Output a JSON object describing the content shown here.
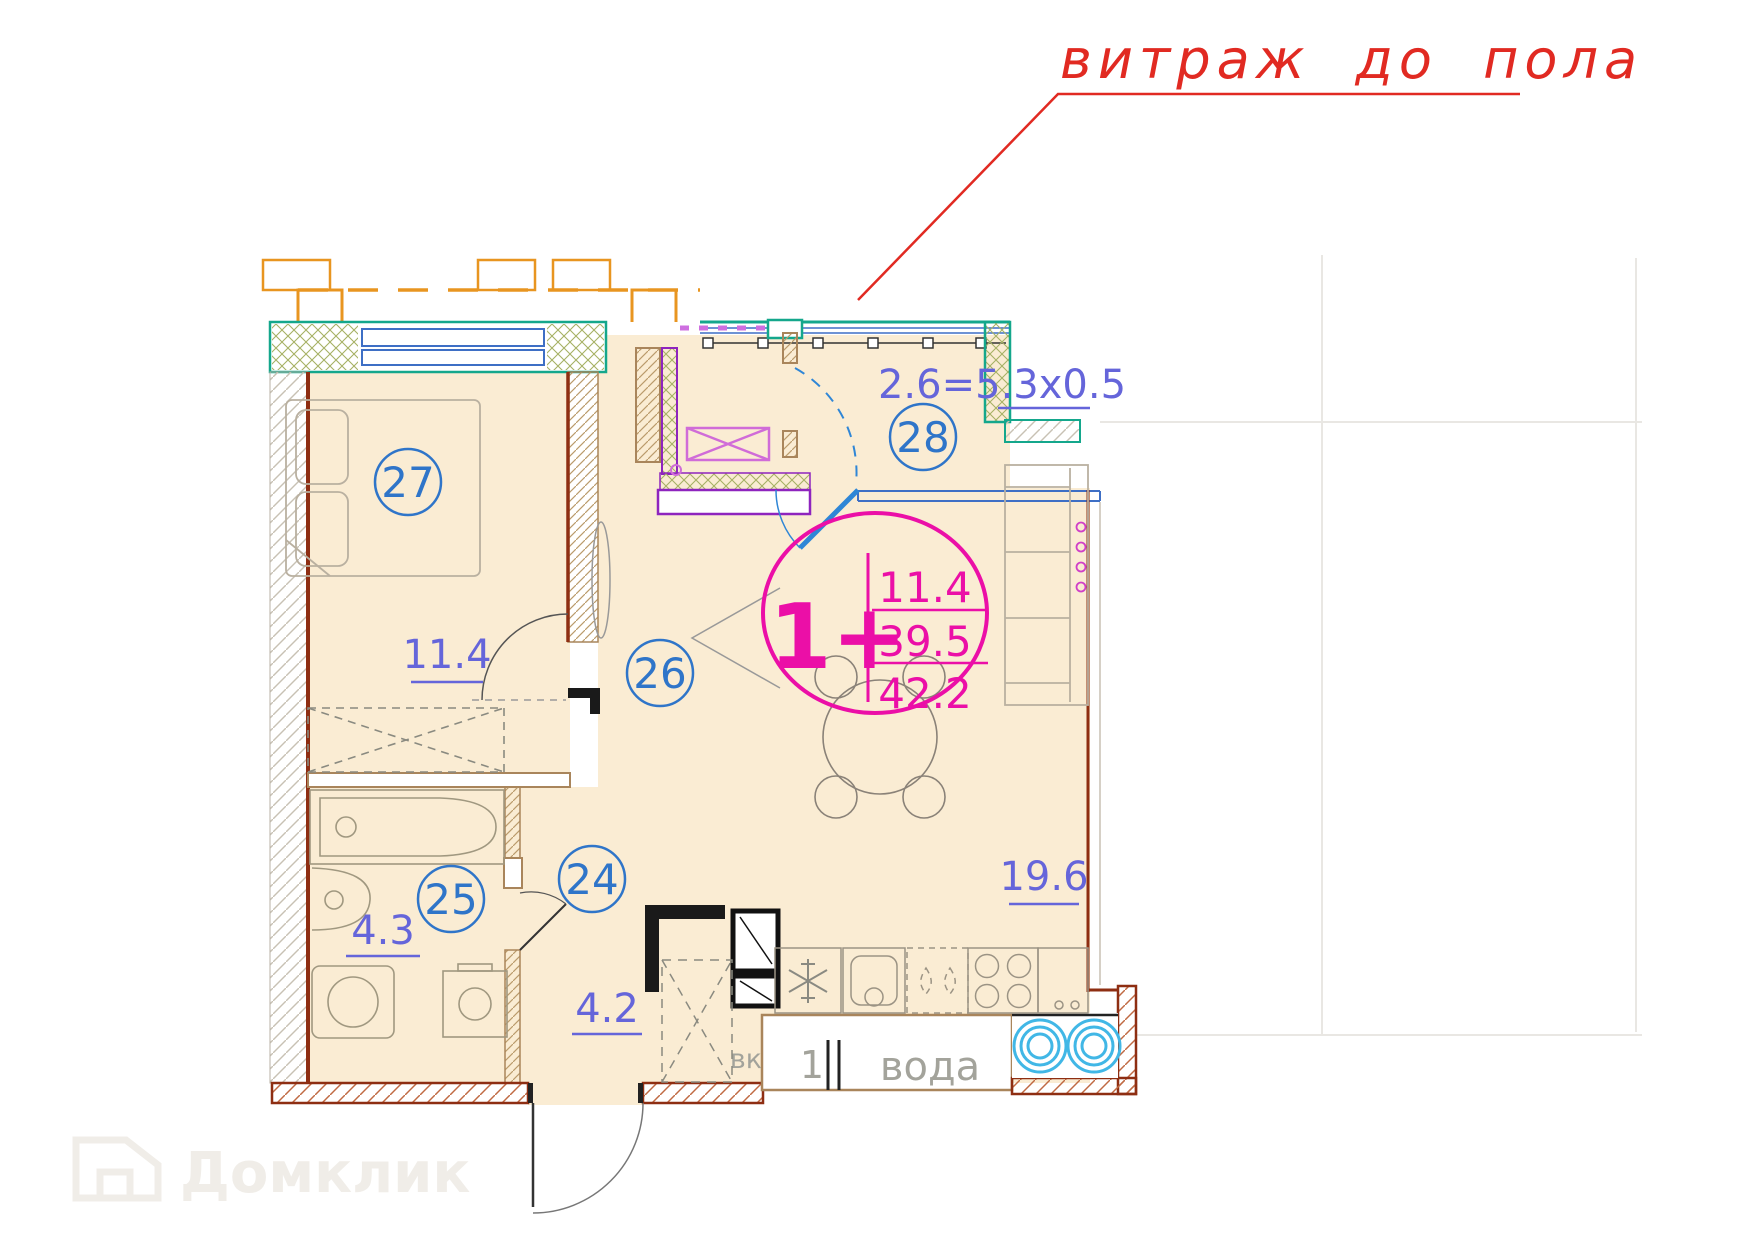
{
  "annotation": {
    "text": "витраж до пола",
    "color": "#E12A22"
  },
  "unit": {
    "type_label": "1+",
    "living_area": "11.4",
    "area_no_balcony": "39.5",
    "total_area": "42.2"
  },
  "balcony": {
    "number": "28",
    "dimension": "2.6=5.3х0.5"
  },
  "rooms": [
    {
      "number": "27",
      "area": "11.4"
    },
    {
      "number": "26",
      "area": "19.6"
    },
    {
      "number": "25",
      "area": "4.3"
    },
    {
      "number": "24",
      "area": "4.2"
    }
  ],
  "service": {
    "water": "вода",
    "vk": "вк",
    "section_mark": "1"
  },
  "watermark": {
    "brand": "Домклик"
  },
  "colors": {
    "accent_magenta": "#EB0FA7",
    "label_blue": "#2F75C9",
    "area_violet": "#6565DA",
    "annotation_red": "#E12A22",
    "wall_teal": "#14A78C",
    "wall_dark_red": "#8E2E12",
    "wall_purple": "#8E24BE",
    "washer_cyan": "#41B7E6",
    "orange": "#E89520"
  }
}
